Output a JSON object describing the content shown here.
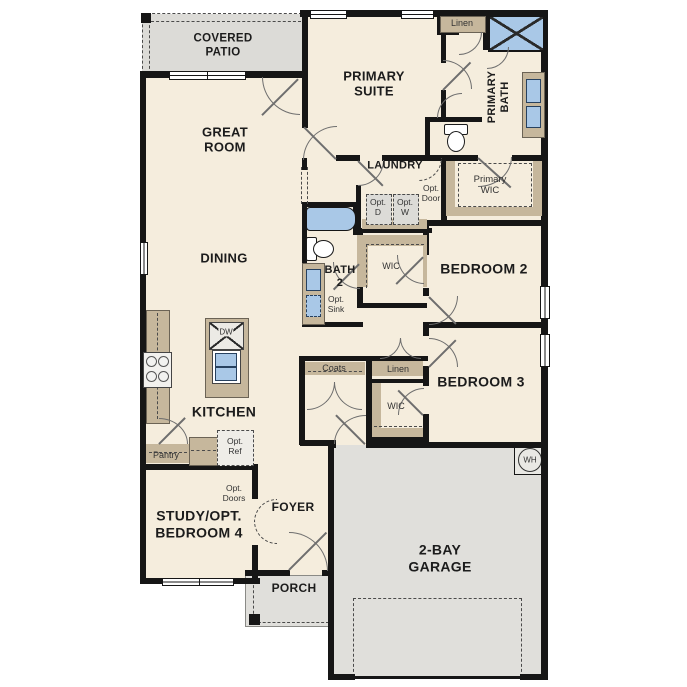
{
  "plan": {
    "rooms": {
      "covered_patio": {
        "line1": "COVERED",
        "line2": "PATIO"
      },
      "great_room": {
        "line1": "GREAT",
        "line2": "ROOM"
      },
      "primary_suite": {
        "line1": "PRIMARY",
        "line2": "SUITE"
      },
      "primary_bath": {
        "line1": "PRIMARY",
        "line2": "BATH"
      },
      "primary_wic": {
        "line1": "Primary",
        "line2": "WIC"
      },
      "laundry": {
        "label": "LAUNDRY"
      },
      "dining": {
        "label": "DINING"
      },
      "bath2": {
        "line1": "BATH",
        "line2": "2"
      },
      "bedroom2": {
        "label": "BEDROOM 2"
      },
      "bedroom3": {
        "label": "BEDROOM 3"
      },
      "kitchen": {
        "label": "KITCHEN"
      },
      "study": {
        "line1": "STUDY/OPT.",
        "line2": "BEDROOM 4"
      },
      "foyer": {
        "label": "FOYER"
      },
      "porch": {
        "label": "PORCH"
      },
      "garage": {
        "line1": "2-BAY",
        "line2": "GARAGE"
      }
    },
    "closets": {
      "linen_primary": "Linen",
      "linen_hall": "Linen",
      "wic_bed2": "WIC",
      "wic_bed3": "WIC",
      "coats": "Coats",
      "pantry": "Pantry"
    },
    "options": {
      "opt_door": {
        "line1": "Opt.",
        "line2": "Door"
      },
      "opt_dryer": {
        "line1": "Opt.",
        "line2": "D"
      },
      "opt_washer": {
        "line1": "Opt.",
        "line2": "W"
      },
      "opt_sink": {
        "line1": "Opt.",
        "line2": "Sink"
      },
      "opt_ref": {
        "line1": "Opt.",
        "line2": "Ref"
      },
      "opt_doors": {
        "line1": "Opt.",
        "line2": "Doors"
      }
    },
    "appliances": {
      "dishwasher": "DW",
      "water_heater": "WH"
    },
    "colors": {
      "floor": "#f5eddd",
      "hardscape": "#e0dfdb",
      "cabinet": "#c6b79c",
      "fixture_blue": "#a9c8e7",
      "wall": "#161616"
    }
  }
}
